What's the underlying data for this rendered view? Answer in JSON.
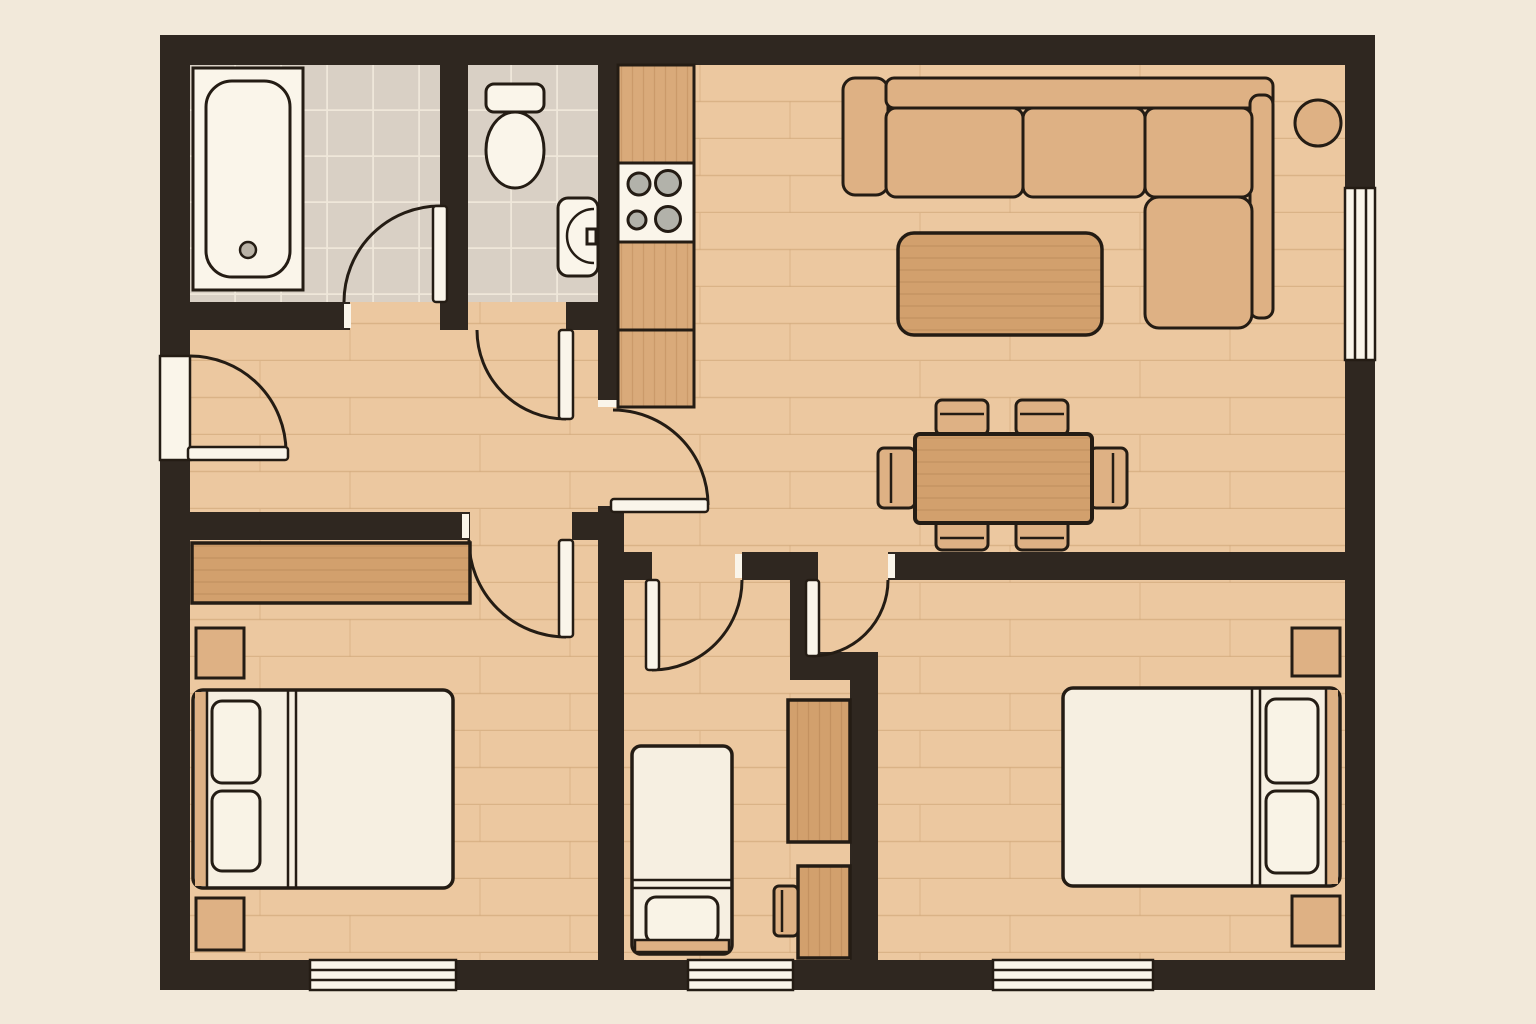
{
  "floor_plan": {
    "title": "apartment-floor-plan",
    "view": "top-down architectural drawing, no text labels",
    "rooms": [
      {
        "id": "bathroom",
        "position": "top-left",
        "floor": "tile",
        "fixtures": [
          "bathtub-with-drain"
        ]
      },
      {
        "id": "wc",
        "position": "top-left-2",
        "floor": "tile",
        "fixtures": [
          "toilet-with-tank",
          "wall-mounted-sink"
        ]
      },
      {
        "id": "kitchen",
        "position": "top-center",
        "floor": "wood-plank",
        "fixtures": [
          "counter-run",
          "cooktop-4-burners",
          "lower-cabinets"
        ]
      },
      {
        "id": "living-room",
        "position": "top-right",
        "floor": "wood-plank",
        "furniture": [
          "l-shaped-sectional-sofa",
          "coffee-table",
          "round-side-table"
        ]
      },
      {
        "id": "dining-area",
        "position": "center-right",
        "floor": "wood-plank",
        "furniture": [
          "rectangular-dining-table",
          "six-dining-chairs"
        ]
      },
      {
        "id": "hallway",
        "position": "center-left",
        "floor": "wood-plank",
        "furniture": []
      },
      {
        "id": "bedroom-left",
        "position": "bottom-left",
        "floor": "wood-plank",
        "furniture": [
          "double-bed",
          "two-pillows",
          "two-nightstands",
          "wide-wardrobe"
        ]
      },
      {
        "id": "small-room",
        "position": "bottom-center",
        "floor": "wood-plank",
        "furniture": [
          "single-bed",
          "tall-wardrobe",
          "desk",
          "desk-chair"
        ]
      },
      {
        "id": "bedroom-right",
        "position": "bottom-right",
        "floor": "wood-plank",
        "furniture": [
          "double-bed",
          "two-pillows",
          "two-nightstands"
        ]
      }
    ],
    "openings": {
      "entrance_door": {
        "wall": "left",
        "swing": "into-hallway"
      },
      "interior_doors": [
        {
          "room": "bathroom",
          "swing": "into-bathroom"
        },
        {
          "room": "wc",
          "swing": "into-hallway"
        },
        {
          "room": "kitchen",
          "swing": "into-dining-area"
        },
        {
          "room": "bedroom-left",
          "swing": "into-bedroom"
        },
        {
          "room": "small-room",
          "swing": "into-room"
        },
        {
          "room": "bedroom-right",
          "swing": "into-bedroom"
        }
      ],
      "windows": [
        {
          "wall": "right",
          "room": "living-room"
        },
        {
          "wall": "bottom",
          "room": "bedroom-left"
        },
        {
          "wall": "bottom",
          "room": "small-room"
        },
        {
          "wall": "bottom",
          "room": "bedroom-right"
        }
      ]
    },
    "palette": {
      "page_background": "#f2e9da",
      "wall": "#2f2720",
      "outline": "#241c14",
      "wood_floor": "#ecc8a0",
      "plank_line": "#c79d6e",
      "tile_floor": "#d9d0c5",
      "tile_grout": "#efe7da",
      "furniture_wood": "#deb184",
      "furniture_wood_grain": "#d9aa7a",
      "furniture_wood_dark": "#d2a06d",
      "fixture_white": "#faf5ea",
      "linen_white": "#f6efe1",
      "burner_gray": "#b2b2aa"
    }
  }
}
